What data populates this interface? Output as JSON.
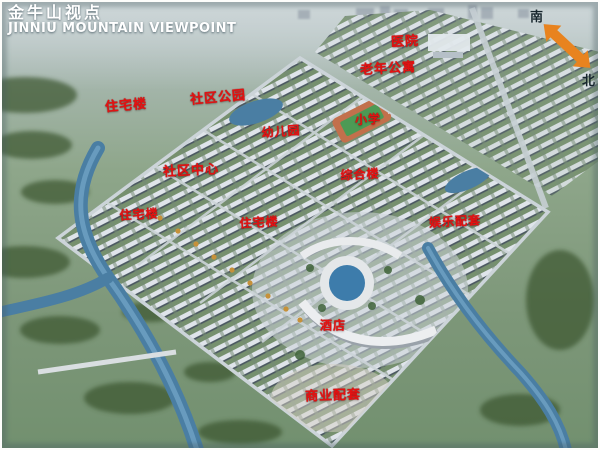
{
  "title": {
    "cn": "金牛山视点",
    "en": "JINNIU MOUNTAIN VIEWPOINT"
  },
  "compass": {
    "south": "南",
    "north": "北",
    "arrow_color": "#e8831f"
  },
  "colors": {
    "label_red": "#e31212",
    "title_white": "#ffffff",
    "water_blue": "#4a7ea3",
    "field_green": "#7d9779",
    "building_light": "#dfe4ea"
  },
  "map_labels": [
    {
      "text": "医院",
      "x": 405,
      "y": 40,
      "size": 13,
      "rot": -3
    },
    {
      "text": "老年公寓",
      "x": 388,
      "y": 67,
      "size": 13,
      "rot": -3
    },
    {
      "text": "住宅楼",
      "x": 126,
      "y": 104,
      "size": 13,
      "rot": -5
    },
    {
      "text": "社区公园",
      "x": 218,
      "y": 96,
      "size": 13,
      "rot": -5
    },
    {
      "text": "幼儿园",
      "x": 281,
      "y": 131,
      "size": 12,
      "rot": -4
    },
    {
      "text": "小学",
      "x": 368,
      "y": 119,
      "size": 12,
      "rot": -3
    },
    {
      "text": "社区中心",
      "x": 191,
      "y": 169,
      "size": 13,
      "rot": -3
    },
    {
      "text": "综合楼",
      "x": 360,
      "y": 174,
      "size": 12,
      "rot": -3
    },
    {
      "text": "住宅楼",
      "x": 139,
      "y": 214,
      "size": 12,
      "rot": -3
    },
    {
      "text": "住宅楼",
      "x": 259,
      "y": 222,
      "size": 12,
      "rot": -3
    },
    {
      "text": "娱乐配套",
      "x": 455,
      "y": 221,
      "size": 12,
      "rot": -3
    },
    {
      "text": "酒店",
      "x": 333,
      "y": 325,
      "size": 12,
      "rot": 0
    },
    {
      "text": "商业配套",
      "x": 333,
      "y": 394,
      "size": 13,
      "rot": -2
    }
  ]
}
